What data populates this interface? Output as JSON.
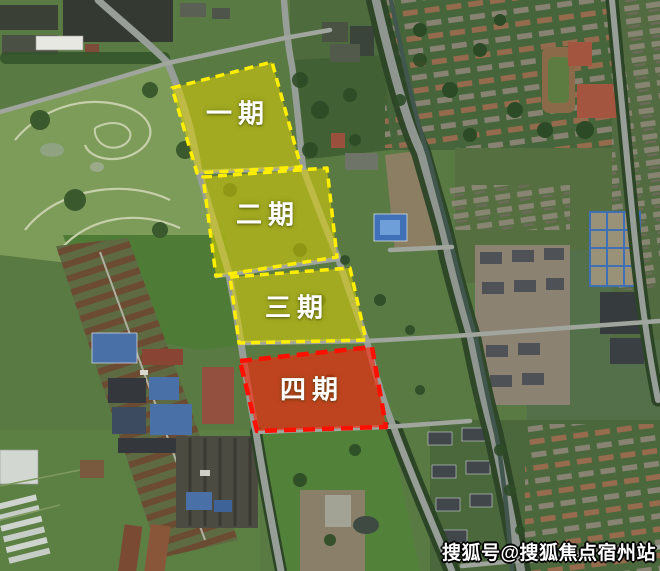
{
  "map": {
    "type": "satellite-annotation",
    "phases": [
      {
        "label": "一期",
        "fill": "#ddd104",
        "border": "#ffee00",
        "text_color": "#ffffff"
      },
      {
        "label": "二期",
        "fill": "#ddd104",
        "border": "#ffee00",
        "text_color": "#ffffff"
      },
      {
        "label": "三期",
        "fill": "#ddd104",
        "border": "#ffee00",
        "text_color": "#ffffff"
      },
      {
        "label": "四期",
        "fill": "#fb2408",
        "border": "#ff0f00",
        "text_color": "#ffffff"
      }
    ]
  },
  "watermark": {
    "text": "搜狐号@搜狐焦点宿州站",
    "color": "#ffffff",
    "outline_color": "#000000"
  }
}
